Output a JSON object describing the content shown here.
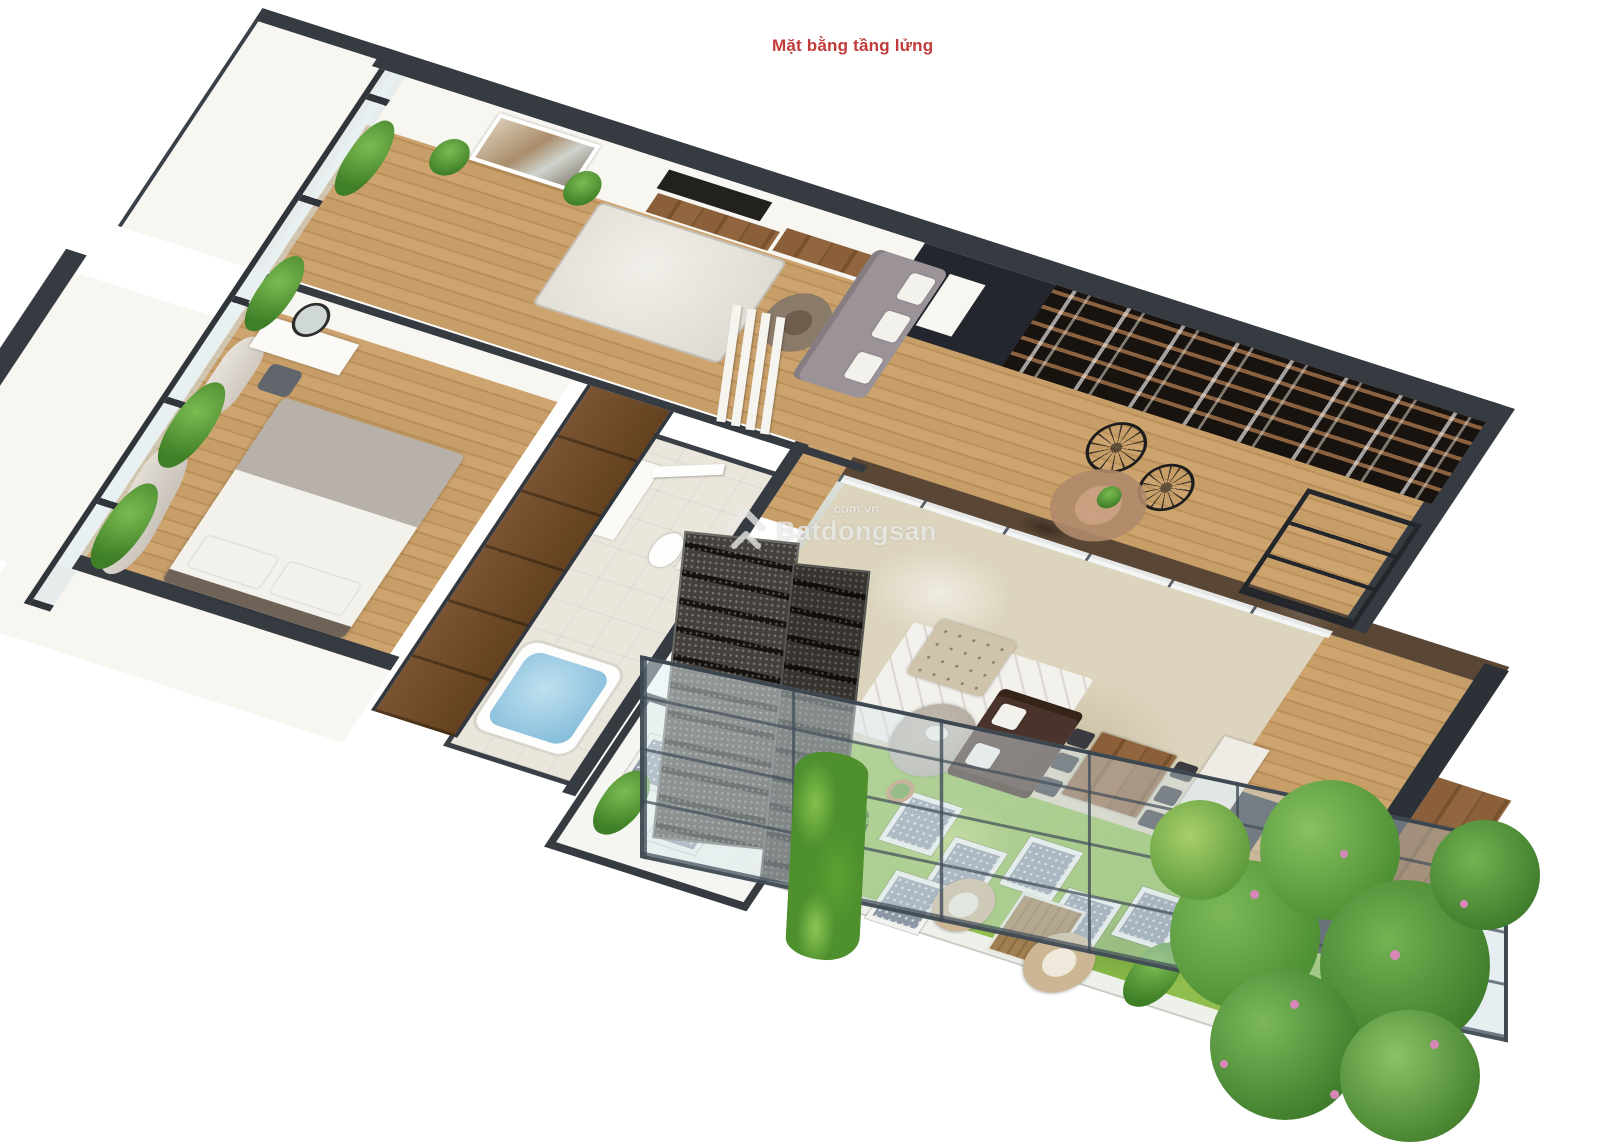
{
  "title": {
    "text": "Mặt bằng tầng lửng"
  },
  "watermark": {
    "name": "Batdongsan",
    "domain": ".com.vn",
    "logo": "double-chevron-house-icon"
  },
  "palette": {
    "wallDark": "#363b42",
    "wallFace": "#f8f6f1",
    "marble": "#dcd4bd",
    "marbleEdge": "#5a4634",
    "tile": "#eae6dc",
    "grass": "#8fbe4e",
    "stone": "#8d98a6",
    "stoneFrame": "#f2f3ef",
    "shelfWood": "#8a6240",
    "shelfBg": "#191310",
    "sofaGray": "#9b9398",
    "sofaBrown": "#49332a",
    "beige": "#cfc3ab",
    "rugWhite": "#f3f1ec",
    "red": "#c23a3a",
    "wm": "#eaeae7",
    "flower": "#d886b8",
    "hedge": "#4e8f2e",
    "tub": "#7fb9d9"
  }
}
